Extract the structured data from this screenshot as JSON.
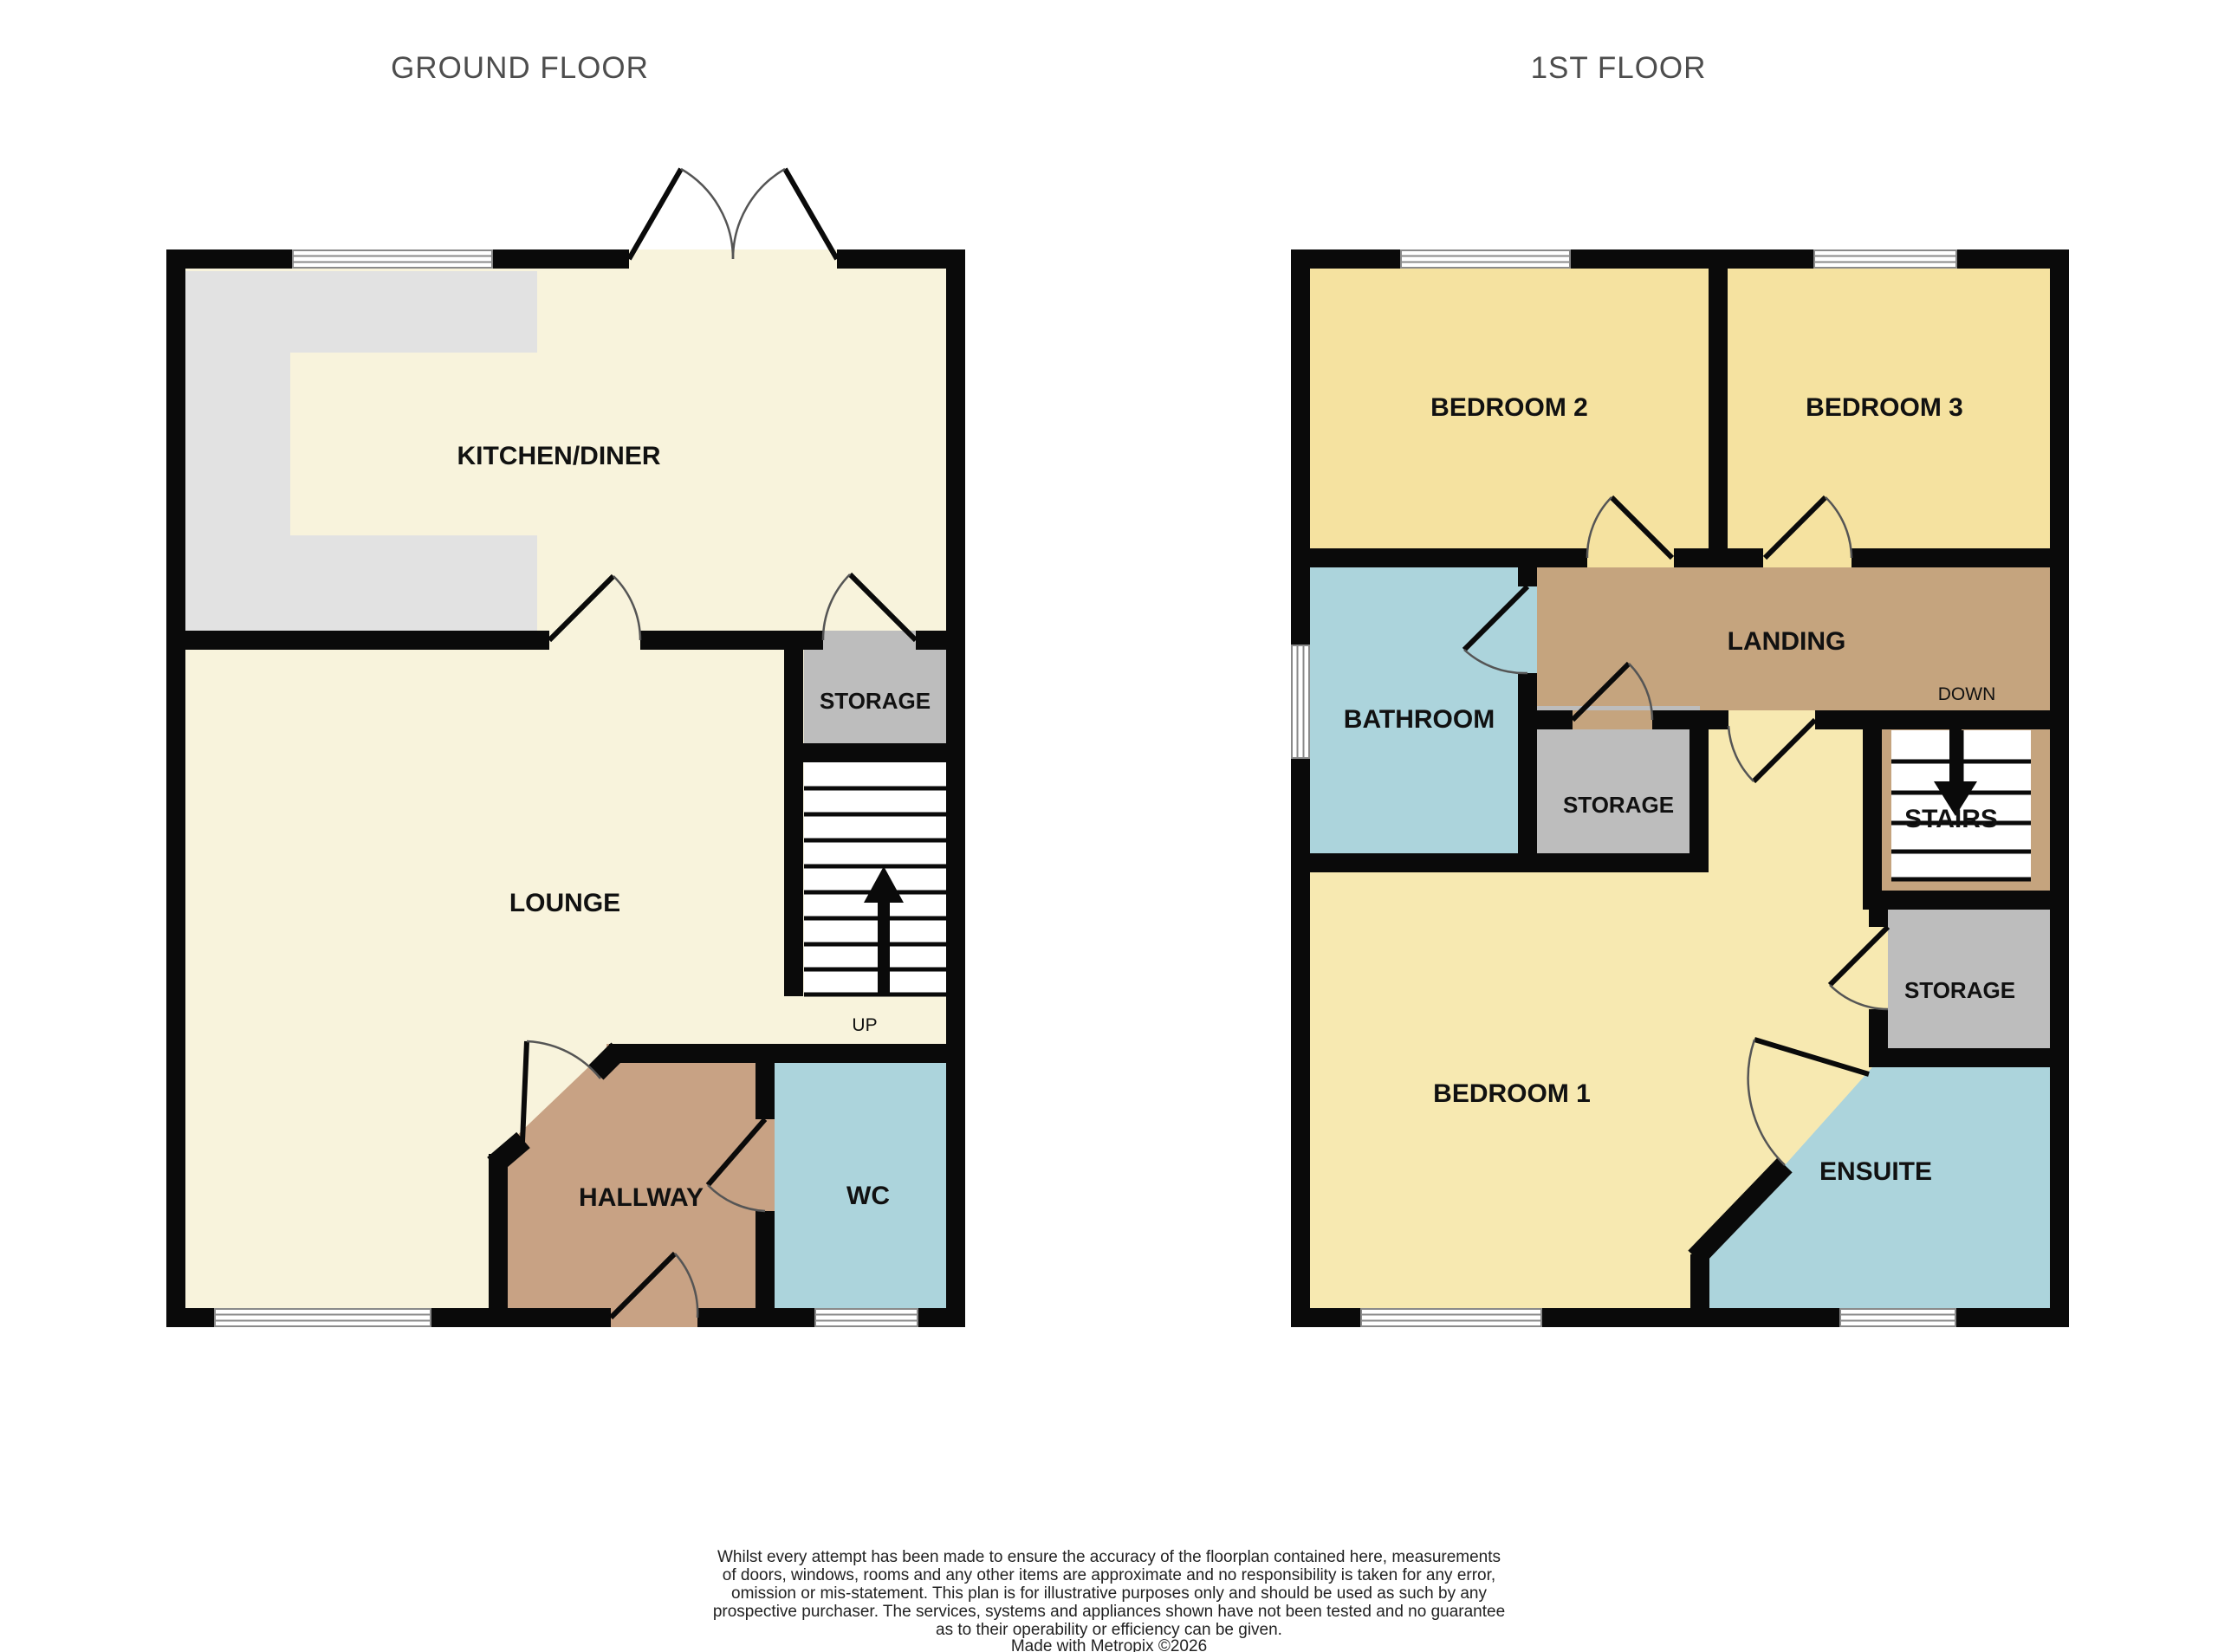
{
  "titles": {
    "ground": "GROUND FLOOR",
    "first": "1ST FLOOR"
  },
  "ground_floor": {
    "kitchen_label": "KITCHEN/DINER",
    "lounge_label": "LOUNGE",
    "storage_label": "STORAGE",
    "hallway_label": "HALLWAY",
    "wc_label": "WC",
    "stairs_direction": "UP"
  },
  "first_floor": {
    "bedroom2_label": "BEDROOM 2",
    "bedroom3_label": "BEDROOM 3",
    "bathroom_label": "BATHROOM",
    "landing_label": "LANDING",
    "storage_mid_label": "STORAGE",
    "storage_right_label": "STORAGE",
    "stairs_label": "STAIRS",
    "stairs_direction": "DOWN",
    "bedroom1_label": "BEDROOM 1",
    "ensuite_label": "ENSUITE"
  },
  "colors": {
    "wall": "#0a0a0a",
    "floor_cream": "#f8f3dc",
    "kitchen_counter_grey": "#e2e2e2",
    "storage_grey": "#bdbdbd",
    "hallway_brown": "#c8a284",
    "landing_brown": "#c5a47e",
    "bathroom_blue": "#acd4dc",
    "bedroom_yellow": "#f5e2a0",
    "bedroom1_yellow": "#f7e9b1",
    "title_grey": "#4d4d4d"
  },
  "footer": {
    "lines": [
      "Whilst every attempt has been made to ensure the accuracy of the floorplan contained here, measurements",
      "of doors, windows, rooms and any other items are approximate and no responsibility is taken for any error,",
      "omission or mis-statement. This plan is for illustrative purposes only and should be used as such by any",
      "prospective purchaser. The services, systems and appliances shown have not been tested and no guarantee",
      "as to their operability or efficiency can be given.",
      "Made with Metropix ©2026"
    ]
  }
}
